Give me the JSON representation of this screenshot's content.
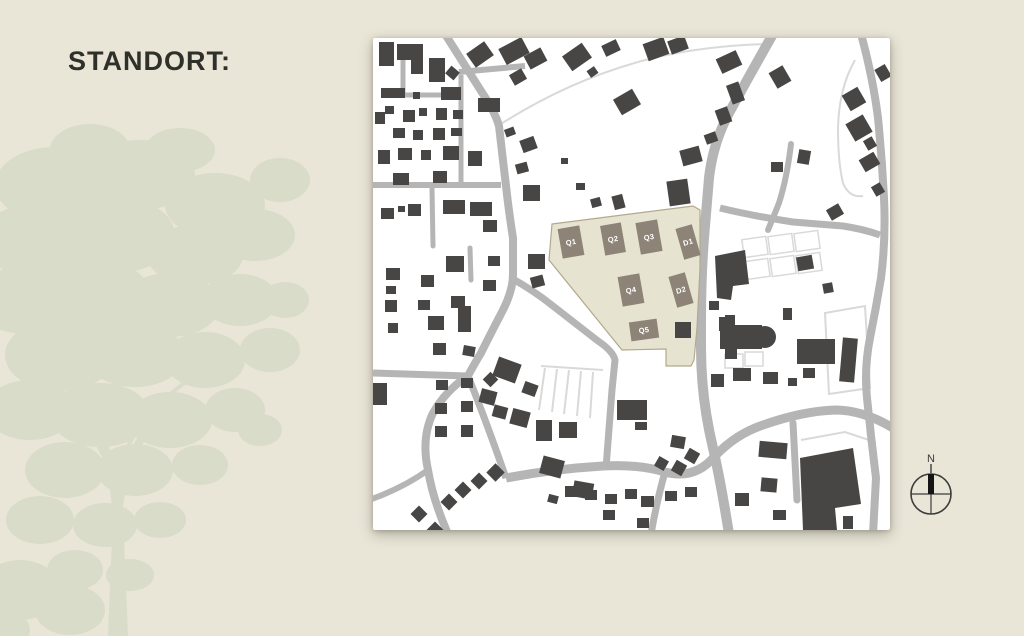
{
  "page": {
    "title": "STANDORT:"
  },
  "compass": {
    "label": "N"
  },
  "colors": {
    "background": "#e9e6d8",
    "tree": "#d9dcc8",
    "title": "#30302b",
    "map_bg": "#ffffff",
    "road": "#b5b5b5",
    "thin": "#d9d9d9",
    "building": "#474645",
    "site_fill": "#e6e3d0",
    "site_stroke": "#b3a98c",
    "plot_fill": "#8d8477",
    "plot_text": "#ffffff",
    "compass_stroke": "#3c3c3c",
    "compass_needle": "#151515"
  },
  "map": {
    "width": 517,
    "height": 492,
    "thin_paths": [
      {
        "d": "M128,86 Q200,40 280,20 Q330,8 392,6"
      },
      {
        "d": "M482,22 Q466,50 465,90 Q465,125 470,145 Q476,160 490,158"
      },
      {
        "d": "M452,275 L492,268 L497,350 L456,356 Z"
      },
      {
        "d": "M428,402 L472,394 L502,404 L500,452"
      }
    ],
    "parcel_rects": [
      [
        370,
        200,
        24,
        18,
        -8
      ],
      [
        396,
        197,
        24,
        18,
        -8
      ],
      [
        422,
        194,
        24,
        18,
        -8
      ],
      [
        372,
        222,
        24,
        18,
        -8
      ],
      [
        398,
        219,
        24,
        18,
        -8
      ],
      [
        424,
        216,
        24,
        18,
        -8
      ],
      [
        352,
        316,
        18,
        14,
        0
      ],
      [
        372,
        314,
        18,
        14,
        0
      ]
    ],
    "roads": [
      {
        "d": "M72,-4 L110,56 Q122,74 126,88 L133,148 Q136,175 140,200 L140,236 Q140,252 130,272 Q118,295 108,315 Q99,330 95,338",
        "w": 8
      },
      {
        "d": "M95,338 Q73,352 60,375 Q48,400 55,432 Q60,462 75,496",
        "w": 8
      },
      {
        "d": "M95,338 Q112,380 133,440",
        "w": 7
      },
      {
        "d": "M0,335 L95,338",
        "w": 7
      },
      {
        "d": "M0,147 L128,147",
        "w": 6
      },
      {
        "d": "M86,34 L152,28",
        "w": 6
      },
      {
        "d": "M30,14 L30,57",
        "w": 5
      },
      {
        "d": "M28,57 L88,57",
        "w": 5
      },
      {
        "d": "M88,37 L88,150",
        "w": 5
      },
      {
        "d": "M59,150 L60,208",
        "w": 5,
        "cap": "round"
      },
      {
        "d": "M97,210 L98,242",
        "w": 5,
        "cap": "round"
      },
      {
        "d": "M138,240 Q160,252 180,268 L225,303 Q240,313 242,322 L239,352 Q236,390 233,430",
        "w": 7
      },
      {
        "d": "M400,-4 Q375,40 356,75 Q340,105 336,140 L331,200 Q328,240 328,280 L328,310 Q328,360 340,410 Q348,445 356,496",
        "w": 10
      },
      {
        "d": "M133,440 Q180,431 230,428 Q265,426 292,434 Q322,442 342,418 Q363,396 390,387 Q430,373 462,372 Q490,372 520,390",
        "w": 9
      },
      {
        "d": "M292,434 Q284,462 278,496",
        "w": 7
      },
      {
        "d": "M420,385 L424,462",
        "w": 7,
        "cap": "round"
      },
      {
        "d": "M488,-4 Q500,40 505,80 Q509,120 511,160 Q513,200 508,240 Q503,270 497,300 Q491,330 494,360 Q498,400 503,440 L500,496",
        "w": 8
      },
      {
        "d": "M347,170 Q380,178 420,184 L470,188 Q490,191 507,197",
        "w": 7
      },
      {
        "d": "M418,106 Q414,140 406,165 Q400,180 395,192",
        "w": 6,
        "cap": "round"
      },
      {
        "d": "M55,432 Q30,450 -4,462",
        "w": 6
      }
    ],
    "parking_lines": [
      "M168,328 L230,332",
      "M172,330 L166,372",
      "M184,331 L179,374",
      "M196,332 L191,376",
      "M208,333 L204,378",
      "M220,334 L217,380"
    ],
    "site": {
      "outline": "179,186 320,168 327,172 327,230 324,290 321,322 318,328 293,328 293,311 249,312 176,222",
      "plots": [
        {
          "label": "Q1",
          "cx": 198,
          "cy": 204,
          "w": 22,
          "h": 30,
          "r": -10
        },
        {
          "label": "Q2",
          "cx": 240,
          "cy": 201,
          "w": 21,
          "h": 30,
          "r": -10
        },
        {
          "label": "Q3",
          "cx": 276,
          "cy": 199,
          "w": 22,
          "h": 32,
          "r": -10
        },
        {
          "label": "D1",
          "cx": 315,
          "cy": 204,
          "w": 17,
          "h": 32,
          "r": -16
        },
        {
          "label": "Q4",
          "cx": 258,
          "cy": 252,
          "w": 22,
          "h": 30,
          "r": -10
        },
        {
          "label": "D2",
          "cx": 308,
          "cy": 252,
          "w": 17,
          "h": 32,
          "r": -16
        },
        {
          "label": "Q5",
          "cx": 271,
          "cy": 292,
          "w": 28,
          "h": 19,
          "r": -8
        }
      ]
    },
    "buildings": [
      [
        6,
        4,
        15,
        24,
        0
      ],
      [
        56,
        20,
        16,
        24,
        0
      ],
      [
        74,
        30,
        11,
        10,
        40
      ],
      [
        96,
        8,
        22,
        17,
        -35
      ],
      [
        128,
        4,
        26,
        18,
        -28
      ],
      [
        153,
        13,
        19,
        15,
        -28
      ],
      [
        192,
        10,
        24,
        18,
        -35
      ],
      [
        215,
        30,
        9,
        8,
        -35
      ],
      [
        230,
        4,
        16,
        12,
        -25
      ],
      [
        8,
        50,
        24,
        10,
        0
      ],
      [
        40,
        54,
        7,
        7,
        0
      ],
      [
        68,
        49,
        20,
        13,
        0
      ],
      [
        105,
        60,
        22,
        14,
        0
      ],
      [
        138,
        33,
        14,
        12,
        -30
      ],
      [
        12,
        68,
        9,
        8,
        0
      ],
      [
        2,
        74,
        10,
        12,
        0
      ],
      [
        30,
        72,
        12,
        12,
        0
      ],
      [
        46,
        70,
        8,
        8,
        0
      ],
      [
        63,
        70,
        11,
        12,
        0
      ],
      [
        80,
        72,
        10,
        9,
        0
      ],
      [
        20,
        90,
        12,
        10,
        0
      ],
      [
        40,
        92,
        10,
        10,
        0
      ],
      [
        60,
        90,
        12,
        12,
        0
      ],
      [
        78,
        90,
        11,
        8,
        0
      ],
      [
        5,
        112,
        12,
        14,
        0
      ],
      [
        25,
        110,
        14,
        12,
        0
      ],
      [
        48,
        112,
        10,
        10,
        0
      ],
      [
        70,
        108,
        16,
        14,
        0
      ],
      [
        95,
        113,
        14,
        15,
        0
      ],
      [
        132,
        90,
        10,
        8,
        -20
      ],
      [
        148,
        100,
        15,
        13,
        -20
      ],
      [
        143,
        125,
        12,
        10,
        -15
      ],
      [
        20,
        135,
        16,
        12,
        0
      ],
      [
        60,
        133,
        14,
        12,
        0
      ],
      [
        97,
        164,
        22,
        14,
        0
      ],
      [
        110,
        182,
        14,
        12,
        0
      ],
      [
        150,
        147,
        17,
        16,
        0
      ],
      [
        188,
        120,
        7,
        6,
        0
      ],
      [
        203,
        145,
        9,
        7,
        0
      ],
      [
        218,
        160,
        10,
        9,
        -15
      ],
      [
        240,
        157,
        11,
        14,
        -15
      ],
      [
        272,
        2,
        22,
        18,
        -20
      ],
      [
        296,
        0,
        18,
        14,
        -20
      ],
      [
        243,
        55,
        22,
        18,
        -30
      ],
      [
        345,
        16,
        22,
        16,
        -25
      ],
      [
        356,
        45,
        13,
        20,
        -20
      ],
      [
        344,
        70,
        13,
        16,
        -20
      ],
      [
        332,
        95,
        12,
        10,
        -20
      ],
      [
        308,
        110,
        20,
        16,
        -15
      ],
      [
        295,
        142,
        21,
        25,
        -8
      ],
      [
        399,
        30,
        16,
        18,
        -30
      ],
      [
        425,
        112,
        12,
        14,
        10
      ],
      [
        398,
        124,
        12,
        10,
        0
      ],
      [
        504,
        28,
        12,
        14,
        -30
      ],
      [
        472,
        52,
        18,
        18,
        -30
      ],
      [
        476,
        80,
        20,
        20,
        -30
      ],
      [
        492,
        100,
        10,
        11,
        -30
      ],
      [
        488,
        117,
        17,
        14,
        -30
      ],
      [
        500,
        146,
        10,
        11,
        -30
      ],
      [
        455,
        168,
        14,
        12,
        -30
      ],
      [
        8,
        170,
        13,
        11,
        0
      ],
      [
        25,
        168,
        7,
        6,
        0
      ],
      [
        35,
        166,
        13,
        12,
        0
      ],
      [
        70,
        162,
        22,
        14,
        0
      ],
      [
        13,
        230,
        14,
        12,
        0
      ],
      [
        13,
        248,
        10,
        8,
        0
      ],
      [
        48,
        237,
        13,
        12,
        0
      ],
      [
        73,
        218,
        18,
        16,
        0
      ],
      [
        115,
        218,
        12,
        10,
        0
      ],
      [
        155,
        216,
        17,
        15,
        0
      ],
      [
        158,
        238,
        13,
        11,
        -15
      ],
      [
        45,
        262,
        12,
        10,
        0
      ],
      [
        78,
        258,
        14,
        12,
        0
      ],
      [
        110,
        242,
        13,
        11,
        0
      ],
      [
        12,
        262,
        12,
        12,
        0
      ],
      [
        85,
        268,
        13,
        26,
        0
      ],
      [
        55,
        278,
        16,
        14,
        0
      ],
      [
        15,
        285,
        10,
        10,
        0
      ],
      [
        60,
        305,
        13,
        12,
        0
      ],
      [
        90,
        308,
        12,
        10,
        10
      ],
      [
        0,
        345,
        14,
        22,
        0
      ],
      [
        63,
        342,
        12,
        10,
        0
      ],
      [
        88,
        340,
        12,
        10,
        0
      ],
      [
        62,
        365,
        12,
        11,
        0
      ],
      [
        88,
        363,
        12,
        11,
        0
      ],
      [
        62,
        388,
        12,
        11,
        0
      ],
      [
        88,
        387,
        12,
        12,
        0
      ],
      [
        112,
        336,
        11,
        11,
        45
      ],
      [
        107,
        352,
        16,
        14,
        15
      ],
      [
        120,
        368,
        14,
        12,
        15
      ],
      [
        122,
        322,
        24,
        20,
        20
      ],
      [
        150,
        345,
        14,
        12,
        20
      ],
      [
        138,
        372,
        18,
        16,
        15
      ],
      [
        84,
        446,
        12,
        12,
        45
      ],
      [
        100,
        437,
        12,
        12,
        45
      ],
      [
        116,
        428,
        13,
        13,
        45
      ],
      [
        70,
        458,
        12,
        12,
        45
      ],
      [
        56,
        486,
        12,
        12,
        45
      ],
      [
        40,
        470,
        12,
        12,
        45
      ],
      [
        168,
        420,
        22,
        18,
        15
      ],
      [
        200,
        444,
        20,
        16,
        10
      ],
      [
        175,
        457,
        10,
        8,
        15
      ],
      [
        163,
        382,
        16,
        21,
        0
      ],
      [
        186,
        384,
        18,
        16,
        0
      ],
      [
        244,
        362,
        30,
        20,
        0
      ],
      [
        262,
        384,
        12,
        8,
        0
      ],
      [
        192,
        448,
        13,
        11,
        0
      ],
      [
        212,
        452,
        12,
        10,
        0
      ],
      [
        232,
        456,
        12,
        10,
        0
      ],
      [
        252,
        451,
        12,
        10,
        0
      ],
      [
        268,
        458,
        13,
        11,
        0
      ],
      [
        292,
        453,
        12,
        10,
        0
      ],
      [
        312,
        449,
        12,
        10,
        0
      ],
      [
        230,
        472,
        12,
        10,
        0
      ],
      [
        264,
        480,
        12,
        10,
        0
      ],
      [
        283,
        420,
        11,
        11,
        30
      ],
      [
        300,
        424,
        12,
        12,
        30
      ],
      [
        313,
        412,
        12,
        12,
        30
      ],
      [
        298,
        398,
        14,
        12,
        10
      ],
      [
        302,
        284,
        16,
        16,
        0
      ],
      [
        336,
        263,
        10,
        9,
        0
      ],
      [
        346,
        279,
        14,
        14,
        0
      ],
      [
        338,
        336,
        13,
        13,
        0
      ],
      [
        352,
        277,
        10,
        10,
        0
      ],
      [
        352,
        311,
        12,
        10,
        0
      ],
      [
        347,
        287,
        42,
        24,
        0
      ],
      [
        410,
        270,
        9,
        12,
        0
      ],
      [
        415,
        340,
        9,
        8,
        0
      ],
      [
        360,
        330,
        18,
        13,
        0
      ],
      [
        390,
        334,
        15,
        12,
        0
      ],
      [
        430,
        330,
        12,
        10,
        0
      ],
      [
        424,
        301,
        38,
        25,
        0
      ],
      [
        468,
        300,
        15,
        44,
        5
      ],
      [
        424,
        218,
        16,
        14,
        -10
      ],
      [
        450,
        245,
        10,
        10,
        -10
      ],
      [
        473,
        452,
        10,
        10,
        0
      ],
      [
        470,
        478,
        10,
        13,
        0
      ],
      [
        362,
        455,
        14,
        13,
        0
      ],
      [
        388,
        440,
        16,
        14,
        5
      ],
      [
        400,
        472,
        13,
        10,
        0
      ],
      [
        386,
        404,
        28,
        16,
        5
      ]
    ],
    "building_polygons": [
      "24,6 50,6 50,36 38,36 38,22 24,22",
      "342,218 372,212 376,246 360,248 358,262 344,260",
      "427,420 480,410 488,466 462,470 464,492 430,492"
    ],
    "building_circles": [
      [
        392,
        299,
        11
      ]
    ]
  },
  "tree": {
    "ellipses": [
      [
        55,
        185,
        60,
        38
      ],
      [
        140,
        175,
        55,
        35
      ],
      [
        215,
        205,
        50,
        32
      ],
      [
        35,
        240,
        55,
        36
      ],
      [
        115,
        235,
        60,
        38
      ],
      [
        195,
        255,
        48,
        30
      ],
      [
        255,
        235,
        40,
        26
      ],
      [
        25,
        300,
        50,
        34
      ],
      [
        95,
        295,
        55,
        36
      ],
      [
        170,
        305,
        50,
        32
      ],
      [
        240,
        300,
        38,
        26
      ],
      [
        285,
        300,
        24,
        18
      ],
      [
        60,
        355,
        55,
        36
      ],
      [
        135,
        355,
        50,
        32
      ],
      [
        205,
        360,
        40,
        28
      ],
      [
        270,
        350,
        30,
        22
      ],
      [
        30,
        410,
        45,
        30
      ],
      [
        100,
        415,
        50,
        32
      ],
      [
        170,
        420,
        42,
        28
      ],
      [
        235,
        410,
        30,
        22
      ],
      [
        260,
        430,
        22,
        16
      ],
      [
        65,
        470,
        40,
        28
      ],
      [
        135,
        470,
        38,
        26
      ],
      [
        200,
        465,
        28,
        20
      ],
      [
        40,
        520,
        34,
        24
      ],
      [
        105,
        525,
        32,
        22
      ],
      [
        160,
        520,
        26,
        18
      ],
      [
        75,
        570,
        28,
        20
      ],
      [
        130,
        575,
        24,
        16
      ],
      [
        280,
        180,
        30,
        22
      ],
      [
        90,
        150,
        40,
        26
      ],
      [
        180,
        150,
        35,
        22
      ],
      [
        20,
        590,
        40,
        30
      ],
      [
        70,
        610,
        35,
        25
      ],
      [
        0,
        630,
        30,
        20
      ]
    ],
    "trunk": "M108,636 L112,540 Q114,500 106,470 L118,466 Q122,500 124,540 L128,636 Z",
    "branches": [
      {
        "d": "M116,500 Q110,440 82,396",
        "w": 7
      },
      {
        "d": "M120,505 Q130,440 172,400",
        "w": 6
      },
      {
        "d": "M118,520 Q121,462 150,422",
        "w": 5
      },
      {
        "d": "M114,480 Q98,432 58,392",
        "w": 5
      },
      {
        "d": "M121,470 Q128,420 200,372",
        "w": 4
      }
    ]
  }
}
